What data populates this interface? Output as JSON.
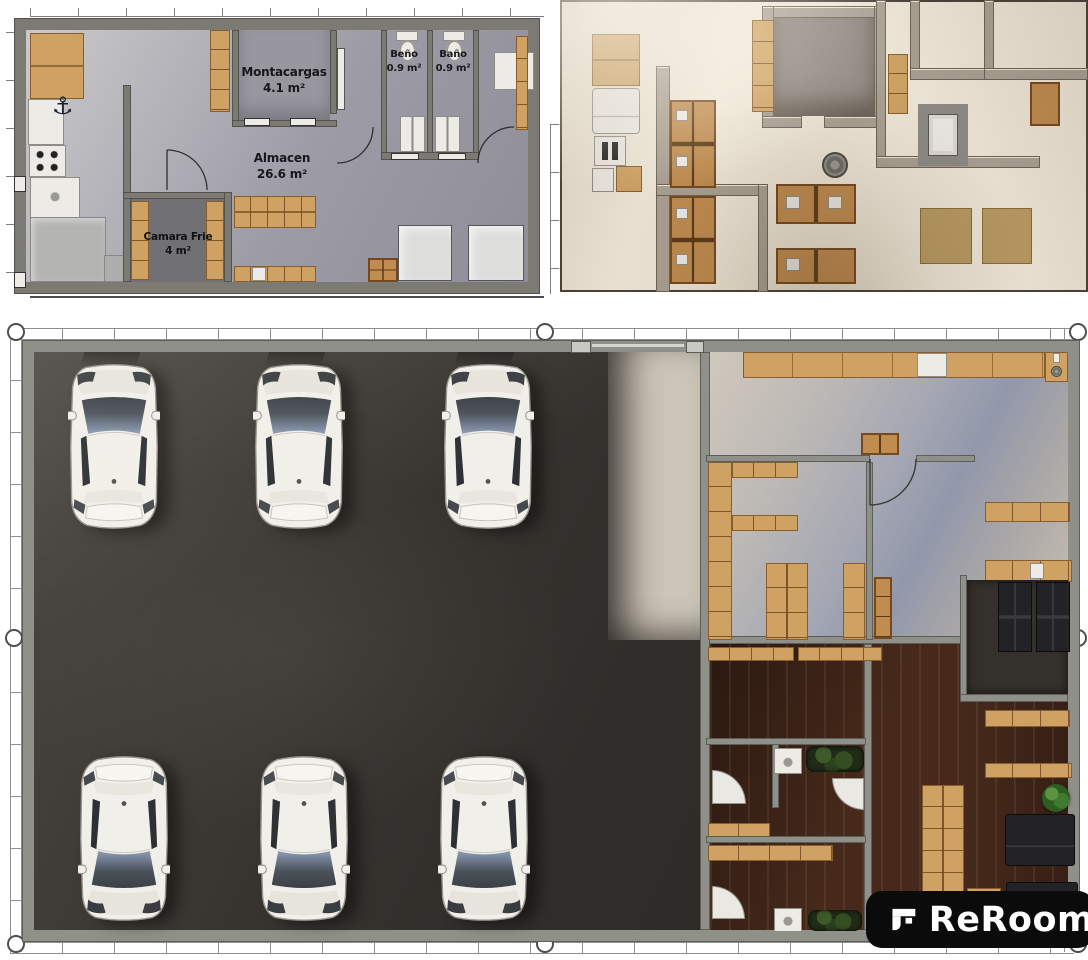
{
  "brand": {
    "logo_text": "ReRoom"
  },
  "floor_plan_2d": {
    "rooms": [
      {
        "name": "Montacargas",
        "area": "4.1 m²"
      },
      {
        "name": "Beño",
        "area": "0.9 m²"
      },
      {
        "name": "Baño",
        "area": "0.9 m²"
      },
      {
        "name": "Almacen",
        "area": "26.6 m²"
      },
      {
        "name": "Camara Frie",
        "area": "4 m²"
      }
    ],
    "anchor_symbol": "⚓"
  },
  "palette": {
    "parking_floor": "#34302d",
    "wood_floor": "#46291b",
    "plan_floor": "#a3a2ab",
    "wall_gray": "#90908a",
    "cabinet_tan": "#cfa263",
    "crate_tan": "#c08c50",
    "render_cream": "#efe7d8",
    "car_body": "#f1efe9",
    "windshield_blue": "#8b9cb6",
    "logo_bg": "#0b0b0c"
  }
}
